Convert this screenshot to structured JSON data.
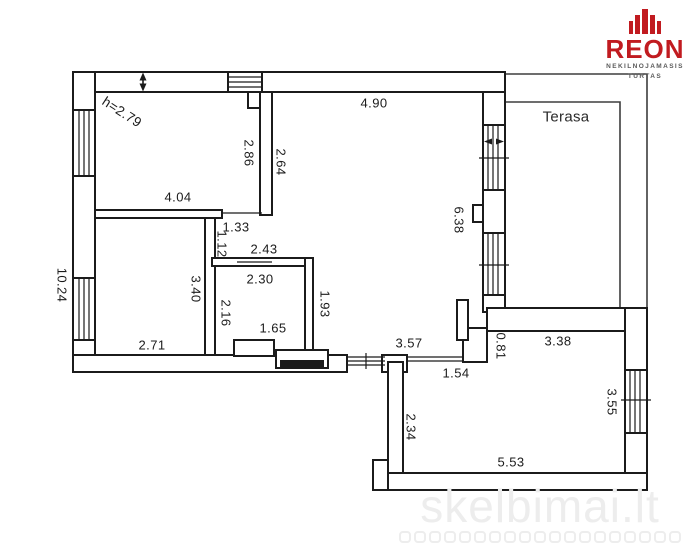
{
  "logo": {
    "brand": "REON",
    "subtitle_line1": "NEKILNOJAMASIS",
    "subtitle_line2": "TURTAS",
    "brand_color": "#c11b20",
    "subtitle_color": "#5a5a5a"
  },
  "watermark": {
    "text": "skelbimai.lt",
    "dots_count": 19,
    "color": "#ededed"
  },
  "floor_plan": {
    "room_labels": {
      "terasa": "Terasa"
    },
    "ceiling_height": "h=2.79",
    "wall_color": "#1b1b1b",
    "dims": {
      "d4_90": "4.90",
      "d2_86": "2.86",
      "d2_64": "2.64",
      "d4_04": "4.04",
      "d10_24": "10.24",
      "d1_33": "1.33",
      "d1_12": "1.12",
      "d2_43": "2.43",
      "d2_30": "2.30",
      "d3_40": "3.40",
      "d2_16": "2.16",
      "d1_65": "1.65",
      "d1_93": "1.93",
      "d2_71": "2.71",
      "d6_38": "6.38",
      "d3_57": "3.57",
      "d1_54": "1.54",
      "d0_81": "0.81",
      "d3_38": "3.38",
      "d3_55": "3.55",
      "d2_34": "2.34",
      "d5_53": "5.53"
    }
  }
}
